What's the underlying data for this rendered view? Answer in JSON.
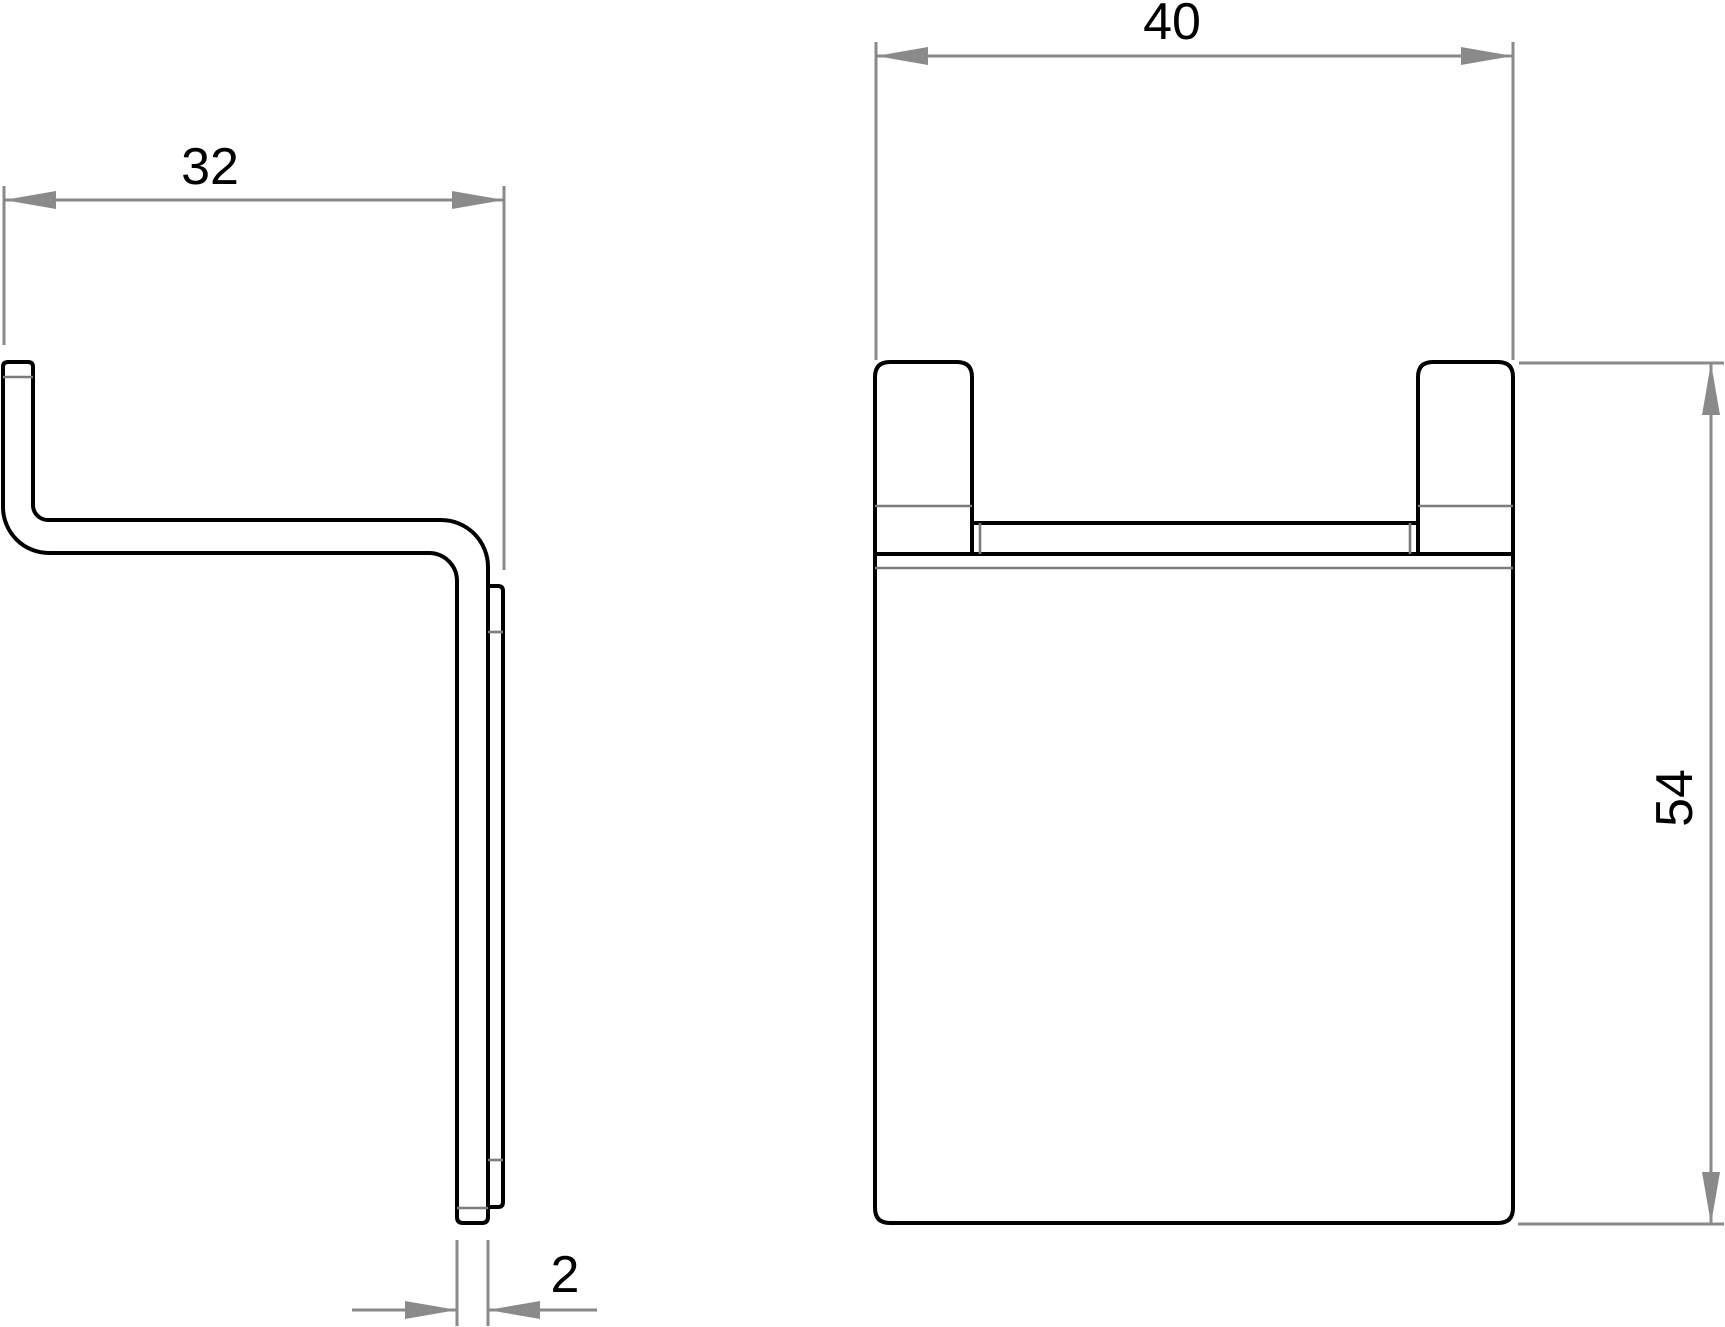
{
  "dimensions": {
    "depth": {
      "value": "32"
    },
    "width": {
      "value": "40"
    },
    "height": {
      "value": "54"
    },
    "thickness": {
      "value": "2"
    }
  },
  "colors": {
    "outline": "#000000",
    "dimension": "#8a8a8a",
    "tangent": "#7b7b7b",
    "text": "#000000",
    "background": "#ffffff"
  }
}
